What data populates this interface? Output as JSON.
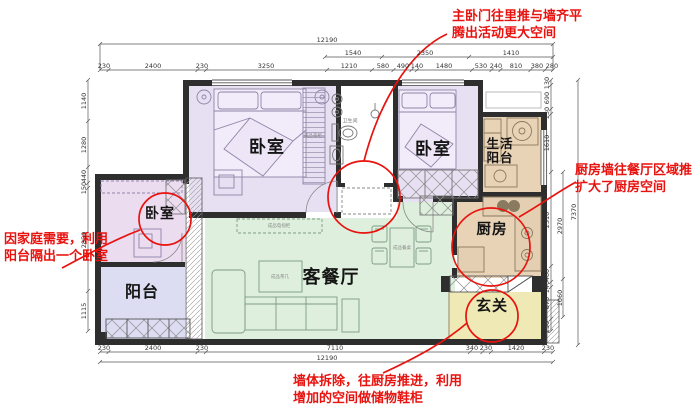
{
  "annotations": {
    "top": "主卧门往里推与墙齐平\n腾出活动更大空间",
    "right": "厨房墙往餐厅区域推\n扩大了厨房空间",
    "left": "因家庭需要，利用\n阳台隔出一个卧室",
    "bottom": "墙体拆除，往厨房推进，利用\n增加的空间做储物鞋柜"
  },
  "rooms": {
    "master_bedroom": "卧室",
    "bedroom2": "卧室",
    "small_bedroom": "卧室",
    "living_dining": "客餐厅",
    "balcony": "阳台",
    "service_balcony": "生活\n阳台",
    "kitchen": "厨房",
    "entry": "玄关",
    "bathroom": "卫生间"
  },
  "furniture_labels": {
    "wardrobe": "成品衣柜",
    "tv_cabinet": "成品电视柜",
    "coffee_table": "成品茶几",
    "dining_set": "成品餐桌"
  },
  "dimensions": {
    "top_total": "12190",
    "top_mid": [
      "1540",
      "2350",
      "1410"
    ],
    "top_detail": [
      "230",
      "2400",
      "230",
      "3250",
      "1210",
      "580",
      "490",
      "140",
      "1480",
      "530",
      "240",
      "810",
      "380",
      "280"
    ],
    "bottom_detail": [
      "230",
      "2400",
      "230",
      "7110",
      "340",
      "230",
      "1420",
      "230"
    ],
    "bottom_total": "12190",
    "left": [
      "1140",
      "1280",
      "440",
      "150",
      "2850",
      "1115"
    ],
    "right_inner": [
      "130",
      "690",
      "130",
      "1610",
      "2510",
      "460",
      "140",
      "870",
      "230"
    ],
    "right_mid": [
      "2970",
      "1060"
    ],
    "right_total": "7370"
  },
  "colors": {
    "bedroom_fill": "#e7dff2",
    "small_bedroom_fill": "#ecdcf0",
    "balcony_fill": "#dcddf2",
    "living_fill": "#def0dd",
    "kitchen_fill": "#e9d3b6",
    "entry_fill": "#efeab5",
    "annotation_red": "#e8120e",
    "wall": "#2e2e2e"
  }
}
